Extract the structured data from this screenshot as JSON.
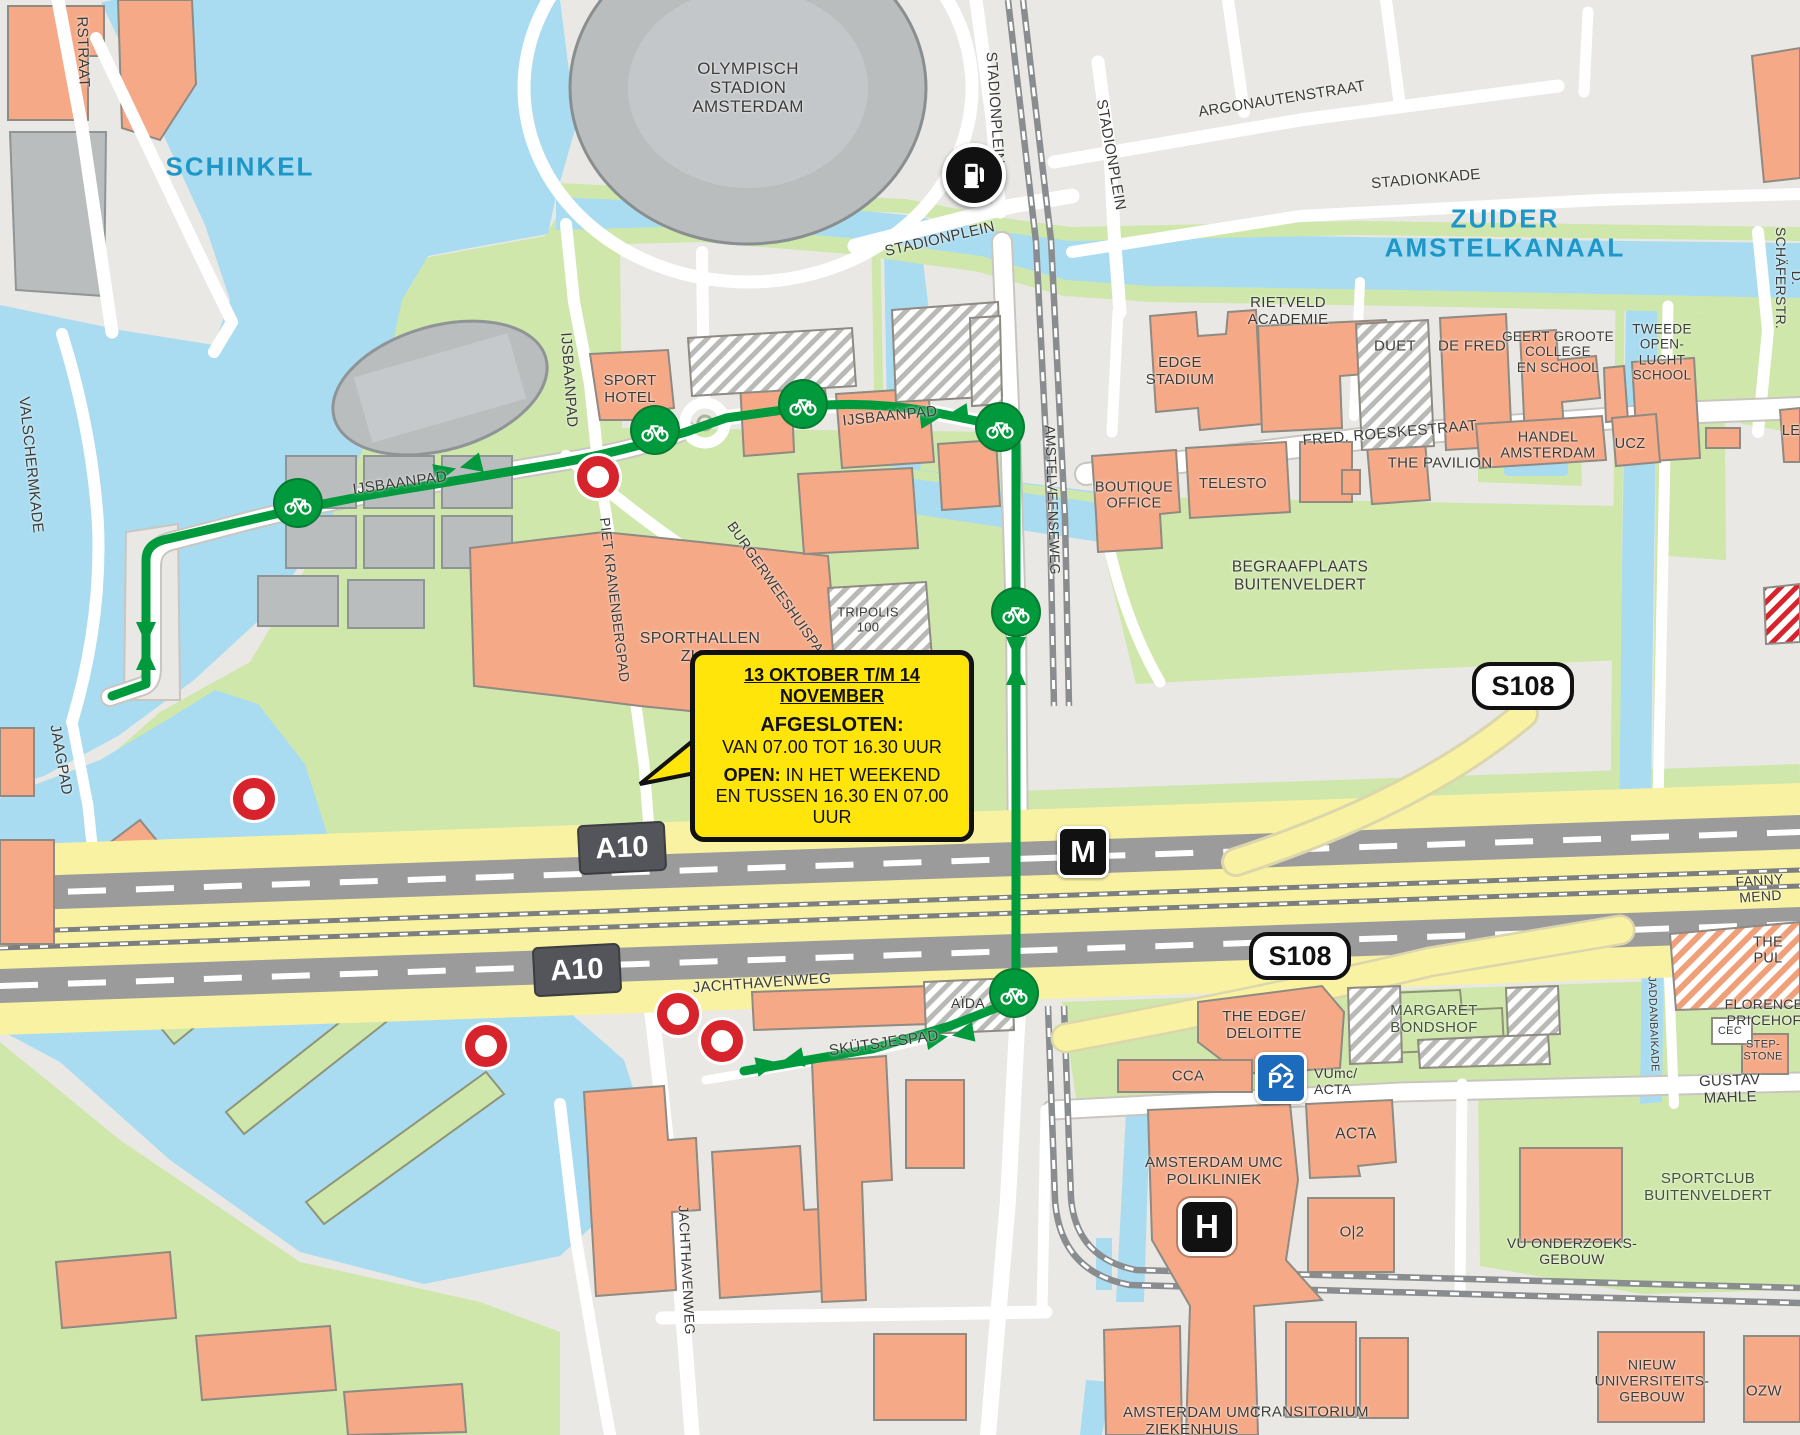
{
  "colors": {
    "land": "#e9e8e4",
    "water": "#a9dcf1",
    "green": "#cfe7ab",
    "building": "#f5a987",
    "gray_building": "#b9bdbe",
    "road": "#ffffff",
    "route": "#009a3d",
    "closure": "#d7232b",
    "highway": "#f8f2a2",
    "carriageway": "#9b9b9b",
    "rail": "#8a8d8f",
    "callout_bg": "#ffe50a",
    "water_label": "#1e96c8",
    "label": "#3b3b38",
    "metro_bg": "#111111",
    "parking_bg": "#1c6bbd"
  },
  "area_labels": {
    "schinkel": {
      "text": "SCHINKEL"
    },
    "zuider_amstelkanaal": {
      "text": "ZUIDER AMSTELKANAAL"
    }
  },
  "street_labels": {
    "rstraat": {
      "text": "RSTRAAT"
    },
    "valschermkade": {
      "text": "VALSCHERMKADE"
    },
    "jaagpad": {
      "text": "JAAGPAD"
    },
    "ijsbaanpad_w": {
      "text": "IJSBAANPAD"
    },
    "ijsbaanpad_c": {
      "text": "IJSBAANPAD"
    },
    "ijsbaanpad_v": {
      "text": "IJSBAANPAD"
    },
    "stadionplein_v1": {
      "text": "STADIONPLEIN"
    },
    "stadionplein_v2": {
      "text": "STADIONPLEIN"
    },
    "stadionplein_h": {
      "text": "STADIONPLEIN"
    },
    "argonautenstraat": {
      "text": "ARGONAUTENSTRAAT"
    },
    "stadionkade": {
      "text": "STADIONKADE"
    },
    "fred_roeskestraat": {
      "text": "FRED. ROESKESTRAAT"
    },
    "amstelveenseweg": {
      "text": "AMSTELVEENSEWEG"
    },
    "burgerweeshuispad": {
      "text": "BURGERWEESHUISPAD"
    },
    "piet_kranenbergpad": {
      "text": "PIET KRANENBERGPAD"
    },
    "jachthavenweg_h": {
      "text": "JACHTHAVENWEG"
    },
    "skutsjespad": {
      "text": "SKÜTSJESPAD"
    },
    "jachthavenweg_v": {
      "text": "JACHTHAVENWEG"
    },
    "gustav_mahlerlaan": {
      "text": "GUSTAV MAHLE"
    },
    "fanny": {
      "text": "FANNY MEND"
    },
    "schaferstr": {
      "text": "D. SCHÄFERSTR."
    },
    "jaddanbaikade": {
      "text": "JADDANBAIKADE"
    }
  },
  "place_labels": {
    "olympisch": {
      "text": "OLYMPISCH\nSTADION\nAMSTERDAM"
    },
    "sport_hotel": {
      "text": "SPORT\nHOTEL"
    },
    "sporthallen": {
      "text": "SPORTHALLEN\nZUID"
    },
    "tripolis": {
      "text": "TRIPOLIS\n100"
    },
    "edge_stadium": {
      "text": "EDGE\nSTADIUM"
    },
    "rietveld": {
      "text": "RIETVELD\nACADEMIE"
    },
    "duet": {
      "text": "DUET"
    },
    "de_fred": {
      "text": "DE FRED"
    },
    "geert_groote": {
      "text": "GEERT GROOTE\nCOLLEGE\nEN SCHOOL"
    },
    "tweede": {
      "text": "TWEEDE\nOPEN-\nLUCHT\nSCHOOL"
    },
    "boutique_office": {
      "text": "BOUTIQUE\nOFFICE"
    },
    "telesto": {
      "text": "TELESTO"
    },
    "pavilion": {
      "text": "THE PAVILION"
    },
    "handel": {
      "text": "HANDEL\nAMSTERDAM"
    },
    "ucz": {
      "text": "UCZ"
    },
    "lev": {
      "text": "LEV"
    },
    "begraafplaats": {
      "text": "BEGRAAFPLAATS\nBUITENVELDERT"
    },
    "aida": {
      "text": "AÏDA"
    },
    "the_edge": {
      "text": "THE EDGE/\nDELOITTE"
    },
    "margaret": {
      "text": "MARGARET\nBONDSHOF"
    },
    "florence": {
      "text": "FLORENCE\nPRICEHOF"
    },
    "the_pul": {
      "text": "THE PUL"
    },
    "cec": {
      "text": "CEC"
    },
    "stepstone": {
      "text": "STEP-\nSTONE"
    },
    "cca": {
      "text": "CCA"
    },
    "vumc_acta": {
      "text": "VUmc/\nACTA"
    },
    "acta": {
      "text": "ACTA"
    },
    "o2": {
      "text": "O|2"
    },
    "umc_poli": {
      "text": "AMSTERDAM UMC\nPOLIKLINIEK"
    },
    "sportclub": {
      "text": "SPORTCLUB\nBUITENVELDERT"
    },
    "vu_onderzoeks": {
      "text": "VU ONDERZOEKS-\nGEBOUW"
    },
    "nieuw_univ": {
      "text": "NIEUW\nUNIVERSITEITS-\nGEBOUW"
    },
    "ozw": {
      "text": "OZW"
    },
    "transitorium": {
      "text": "TRANSITORIUM"
    },
    "umc_ziekenhuis": {
      "text": "AMSTERDAM UMC\nZIEKENHUIS"
    }
  },
  "badges": {
    "a10": "A10",
    "s108": "S108"
  },
  "icons": {
    "metro": "M",
    "hospital": "H",
    "parking": "P2"
  },
  "callout": {
    "title": "13 OKTOBER T/M 14 NOVEMBER",
    "closed_heading": "AFGESLOTEN:",
    "closed_hours": "VAN 07.00 TOT 16.30 UUR",
    "open_heading": "OPEN:",
    "open_when": "IN HET WEEKEND",
    "open_hours": "EN TUSSEN 16.30 EN 07.00 UUR"
  }
}
